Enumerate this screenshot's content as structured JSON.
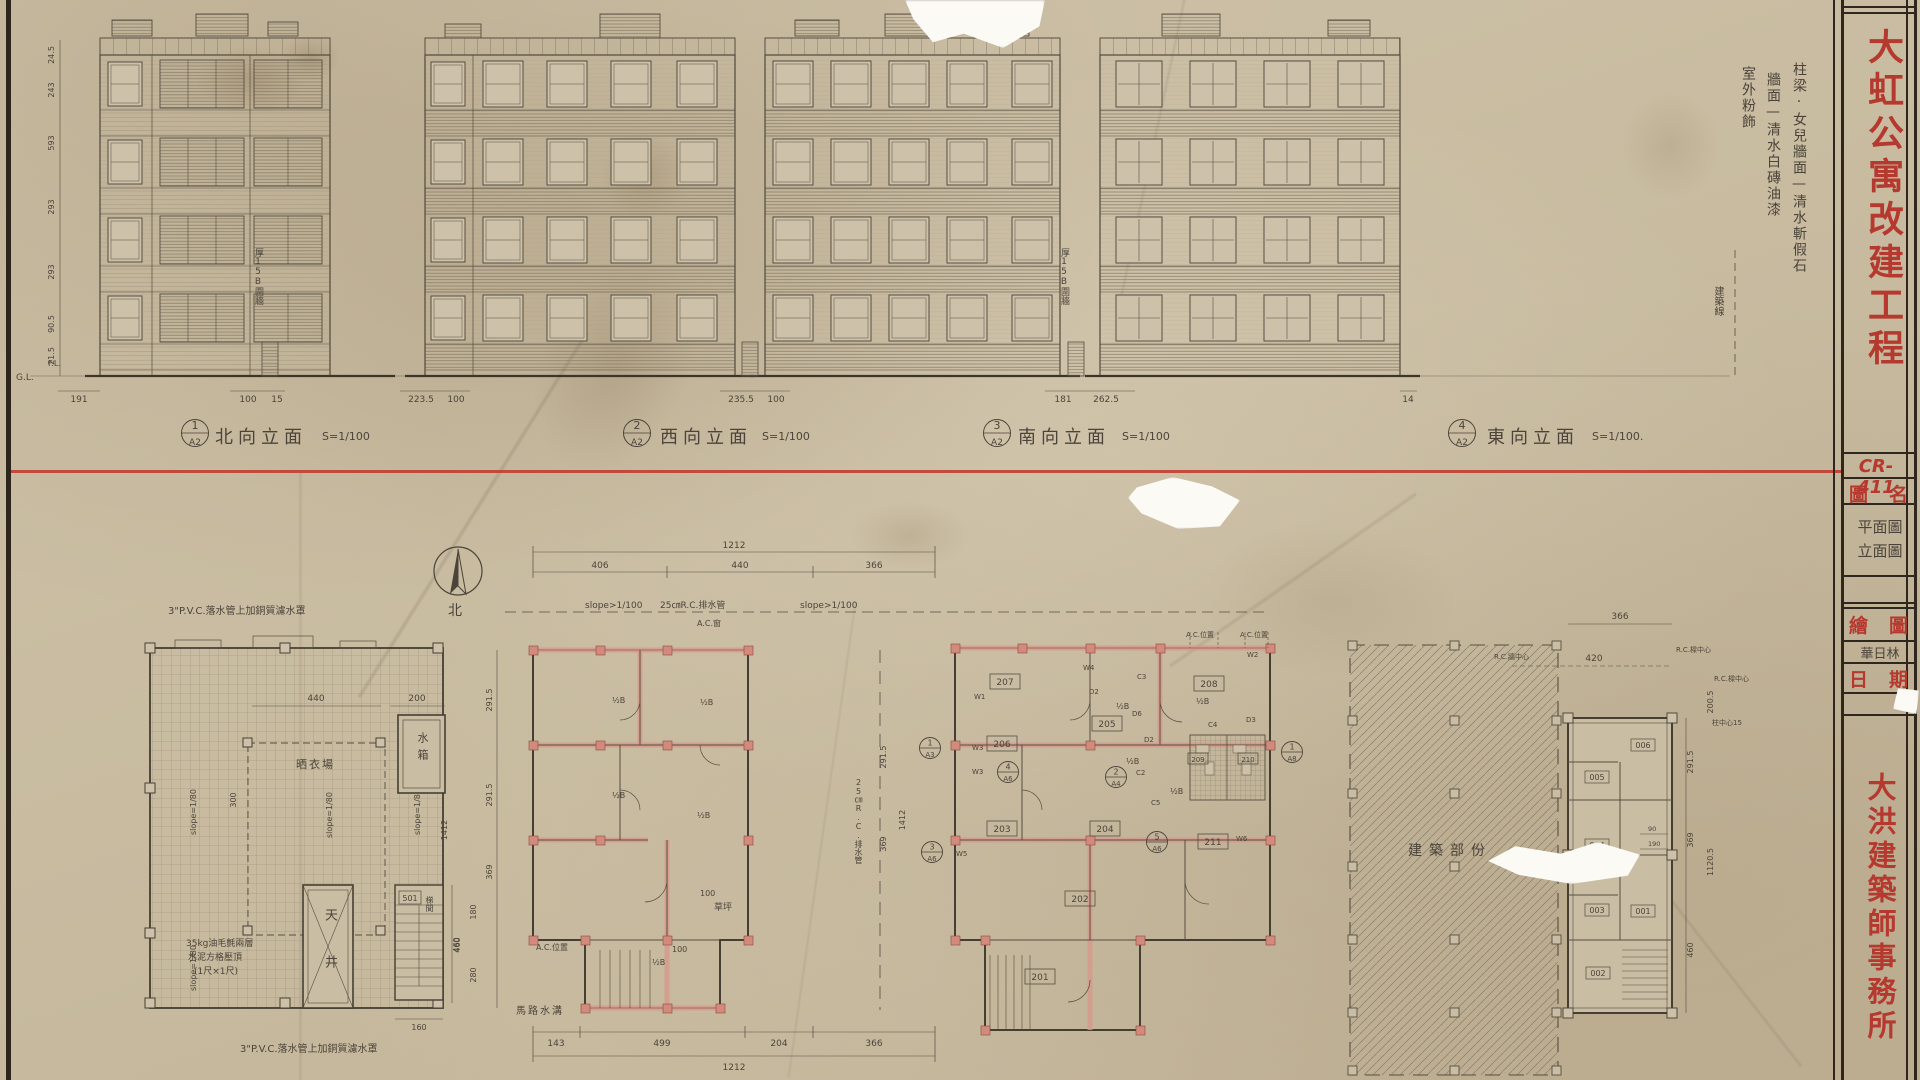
{
  "tb": {
    "project_title": "大虹公寓改建工程",
    "sheet_no": "CR-411",
    "f_name": "圖名",
    "name1": "平面圖",
    "name2": "立面圖",
    "f_draw": "繪圖",
    "drawn_by": "華日林",
    "f_date": "日期",
    "firm": "大洪建築師事務所"
  },
  "notes": {
    "finish1": "柱梁·女兒牆面—清水斬假石",
    "finish2": "牆面—清水白磚油漆",
    "finish3": "室外粉飾",
    "bline": "建築線",
    "fence": "厚15B圍牆"
  },
  "elev": {
    "gl": "G.L.",
    "fl": "F.L.",
    "e": [
      {
        "num": "1",
        "sh": "A2",
        "title": "北向立面",
        "scale": "S=1/100"
      },
      {
        "num": "2",
        "sh": "A2",
        "title": "西向立面",
        "scale": "S=1/100"
      },
      {
        "num": "3",
        "sh": "A2",
        "title": "南向立面",
        "scale": "S=1/100"
      },
      {
        "num": "4",
        "sh": "A2",
        "title": "東向立面",
        "scale": "S=1/100."
      }
    ],
    "g_dims": [
      "191",
      "100",
      "15",
      "223.5",
      "100",
      "235.5",
      "100",
      "181",
      "262.5",
      "14"
    ],
    "l_dims": [
      "24.5",
      "243",
      "593",
      "293",
      "293",
      "90.5",
      "21.5"
    ]
  },
  "compass": {
    "north": "北"
  },
  "roof": {
    "note_top": "3\"P.V.C.落水管上加銅質濾水罩",
    "note_bottom": "3\"P.V.C.落水管上加銅質濾水罩",
    "slope": "slope=1/80",
    "drying": "晒衣場",
    "tank": "水箱",
    "well": "天井",
    "stair": "梯間",
    "stair_no": "501",
    "note1": "35kg油毛氈兩層",
    "note2": "水泥方格壓頂",
    "note3": "(1尺×1尺)",
    "d440": "440",
    "d300": "300",
    "d200": "200",
    "d460": "460",
    "d160": "160"
  },
  "typ": {
    "slope": "slope>1/100",
    "drain": "25㎝R.C.排水管",
    "acw": "A.C.窗",
    "acp": "A.C.位置",
    "gutter": "馬路水溝",
    "lawn": "草坪",
    "hb": "½B",
    "d100": "100",
    "top_total": "1212",
    "t406": "406",
    "t440": "440",
    "t366": "366",
    "b143": "143",
    "b499": "499",
    "b204": "204",
    "b366": "366",
    "bot_total": "1212",
    "l2915": "291.5",
    "l2915b": "291.5",
    "l369": "369",
    "l180": "180",
    "l280": "280",
    "l460": "460",
    "l1412": "1412"
  },
  "gap": {
    "d2915": "291.5",
    "d369": "369",
    "d1412": "1412",
    "drain": "25㎝R.C.排水管"
  },
  "gnd": {
    "rooms": [
      "201",
      "202",
      "203",
      "204",
      "205",
      "206",
      "207",
      "208",
      "209",
      "210",
      "211"
    ],
    "w": [
      "W1",
      "W2",
      "W3",
      "W3",
      "W4",
      "W5",
      "W6"
    ],
    "c": [
      "C2",
      "C3",
      "C4",
      "C5"
    ],
    "d": [
      "D2",
      "D2",
      "D3",
      "D6"
    ],
    "hb": "½B",
    "acp": "A.C.位置",
    "slope": "slope>1/100",
    "m": [
      {
        "n": "1",
        "s": "A3"
      },
      {
        "n": "2",
        "s": "A4"
      },
      {
        "n": "3",
        "s": "A6"
      },
      {
        "n": "4",
        "s": "A6"
      },
      {
        "n": "5",
        "s": "A6"
      },
      {
        "n": "1",
        "s": "A8"
      }
    ]
  },
  "site": {
    "label": "建築部份",
    "d366": "366",
    "d420": "420",
    "rcw": "R.C.牆中心",
    "rcb": "R.C.樑中心",
    "rcb2": "R.C.樑中心",
    "colc": "柱中心15",
    "rooms": [
      "001",
      "002",
      "003",
      "004",
      "005",
      "006"
    ],
    "r2915": "291.5",
    "r369": "369",
    "r460": "460",
    "r11205": "1120.5",
    "r2005": "200.5",
    "d90": "90",
    "d190": "190"
  }
}
